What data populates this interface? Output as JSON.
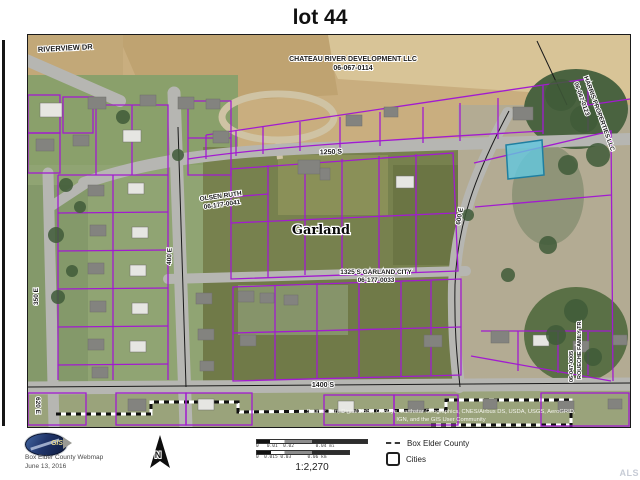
{
  "title": "lot 44",
  "map": {
    "highlight_color": "#62c8e0",
    "parcel_line_color": "#a21bd0",
    "labels": {
      "riverview_dr": "RIVERVIEW DR",
      "chateau_line1": "CHATEAU RIVER DEVELOPMENT LLC",
      "chateau_line2": "06-067-0114",
      "harris_line1": "HARRIS PROPERTIES LLC",
      "harris_line2": "06-067-0123",
      "street_1250s": "1250 S",
      "olsen_line1": "OLSEN RUTH",
      "olsen_line2": "06-177-0041",
      "city_name": "Garland",
      "street_1325s_line1": "1325 S GARLAND CITY",
      "street_1325s_line2": "06-177-0033",
      "street_1400s": "1400 S",
      "street_350e": "350 E",
      "street_400e": "400 E",
      "street_600e": "600 E",
      "street_620e": "620 E",
      "roueche_line1": "ROUECHE FAMILY TR",
      "roueche_line2": "06-047-0005",
      "attribution_line1": "Source: Esri, DigitalGlobe, GeoEye, Earthstar Geographics, CNES/Airbus DS, USDA, USGS, AeroGRID,",
      "attribution_line2": "IGN, and the GIS User Community"
    }
  },
  "footer": {
    "logo_text": "GIS",
    "webmap_name": "Box Elder County Webmap",
    "date": "June 13, 2016",
    "north_label": "N",
    "scale": {
      "bar1_ticks": "0   0.01  0.02        0.04 mi",
      "bar2_ticks": "0  0.015 0.03      0.06 km",
      "ratio": "1:2,270"
    },
    "legend": {
      "items": [
        {
          "label": "Box Elder County"
        },
        {
          "label": "Cities"
        }
      ]
    },
    "watermark": "ALS"
  }
}
